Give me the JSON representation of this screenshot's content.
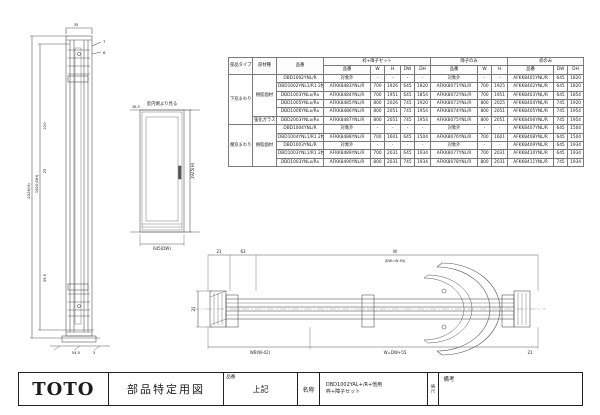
{
  "title_block": {
    "logo": "TOTO",
    "doc_type": "部品特定用図",
    "hinban_label": "品番",
    "hinban_value": "上記",
    "meisho_label": "名称",
    "meisho_line1": "DBD1002YAL+/R+他用",
    "meisho_line2": "枠+障子セット",
    "scale_label": "縮尺",
    "biko_label": "備考"
  },
  "table": {
    "group_headers": [
      "枠+障子セット",
      "障子のみ",
      "枠のみ"
    ],
    "fixed_headers": [
      "部品タイプ",
      "部材種",
      "品番"
    ],
    "sub_headers_set": [
      "品番",
      "W",
      "H",
      "DW",
      "DH"
    ],
    "sub_headers_sash": [
      "品番",
      "W",
      "H"
    ],
    "sub_headers_frame": [
      "品番",
      "DW",
      "DH"
    ],
    "na_text": "対象外",
    "rows": [
      [
        {
          "t": "下窓まわり",
          "rs": 6
        },
        {
          "t": "樹脂面材",
          "rs": 5
        },
        {
          "t": "DBD1002YNL/R"
        },
        {
          "t": "対象外"
        },
        {
          "t": "-"
        },
        {
          "t": "-"
        },
        {
          "t": "-"
        },
        {
          "t": "-"
        },
        {
          "t": "対象外"
        },
        {
          "t": "-"
        },
        {
          "t": "-"
        },
        {
          "t": "AFKK8401YNL/R"
        },
        {
          "t": "645"
        },
        {
          "t": "1820"
        }
      ],
      [
        {
          "t": "DBD1002YNL1/R1 2枚"
        },
        {
          "t": "AFKK8483YNL/R"
        },
        {
          "t": "700"
        },
        {
          "t": "1926"
        },
        {
          "t": "645"
        },
        {
          "t": "1820"
        },
        {
          "t": "AFKK8071YNL/R"
        },
        {
          "t": "700"
        },
        {
          "t": "1925"
        },
        {
          "t": "AFKK8402YNL/R"
        },
        {
          "t": "645"
        },
        {
          "t": "1820"
        }
      ],
      [
        {
          "t": "DBD1003YNLx/Rx"
        },
        {
          "t": "AFKK8484YNL/R"
        },
        {
          "t": "700"
        },
        {
          "t": "1951"
        },
        {
          "t": "645"
        },
        {
          "t": "1854"
        },
        {
          "t": "AFKK8072YNL/R"
        },
        {
          "t": "700"
        },
        {
          "t": "1951"
        },
        {
          "t": "AFKK8403YNL/R"
        },
        {
          "t": "645"
        },
        {
          "t": "1854"
        }
      ],
      [
        {
          "t": "DBD1005YNLx/Rx"
        },
        {
          "t": "AFKK8485YNL/R"
        },
        {
          "t": "800"
        },
        {
          "t": "2026"
        },
        {
          "t": "745"
        },
        {
          "t": "1920"
        },
        {
          "t": "AFKK8073YNL/R"
        },
        {
          "t": "800"
        },
        {
          "t": "2025"
        },
        {
          "t": "AFKK8404YNL/R"
        },
        {
          "t": "745"
        },
        {
          "t": "1920"
        }
      ],
      [
        {
          "t": "DBD1006YNLx/Rx"
        },
        {
          "t": "AFKK8486YNL/R"
        },
        {
          "t": "800"
        },
        {
          "t": "2051"
        },
        {
          "t": "745"
        },
        {
          "t": "1954"
        },
        {
          "t": "AFKK8074YNL/R"
        },
        {
          "t": "800"
        },
        {
          "t": "2051"
        },
        {
          "t": "AFKK8405YNL/R"
        },
        {
          "t": "745"
        },
        {
          "t": "1954"
        }
      ],
      [
        {
          "t": "強化ガラス"
        },
        {
          "t": "DBD2003YNLx/Rx"
        },
        {
          "t": "AFKK8487YNL/R"
        },
        {
          "t": "800"
        },
        {
          "t": "2051"
        },
        {
          "t": "745"
        },
        {
          "t": "1954"
        },
        {
          "t": "AFKK8075YNL/R"
        },
        {
          "t": "800"
        },
        {
          "t": "2051"
        },
        {
          "t": "AFKK8406YNL/R"
        },
        {
          "t": "745"
        },
        {
          "t": "1954"
        }
      ],
      [
        {
          "t": "腰窓まわり",
          "rs": 5
        },
        {
          "t": "樹脂面材",
          "rs": 5
        },
        {
          "t": "DBD1004YNL/R"
        },
        {
          "t": "対象外"
        },
        {
          "t": "-"
        },
        {
          "t": "-"
        },
        {
          "t": "-"
        },
        {
          "t": "-"
        },
        {
          "t": "対象外"
        },
        {
          "t": "-"
        },
        {
          "t": "-"
        },
        {
          "t": "AFKK8407YNL/R"
        },
        {
          "t": "645"
        },
        {
          "t": "1504"
        }
      ],
      [
        {
          "t": "DBD1004YNL1/R1 2枚"
        },
        {
          "t": "AFKK8488YNL/R"
        },
        {
          "t": "700"
        },
        {
          "t": "1601"
        },
        {
          "t": "645"
        },
        {
          "t": "1504"
        },
        {
          "t": "AFKK8076YNL/R"
        },
        {
          "t": "700"
        },
        {
          "t": "1601"
        },
        {
          "t": "AFKK8408YNL/R"
        },
        {
          "t": "645"
        },
        {
          "t": "1504"
        }
      ],
      [
        {
          "t": "DBD1003YNL/R"
        },
        {
          "t": "対象外"
        },
        {
          "t": "-"
        },
        {
          "t": "-"
        },
        {
          "t": "-"
        },
        {
          "t": "-"
        },
        {
          "t": "対象外"
        },
        {
          "t": "-"
        },
        {
          "t": "-"
        },
        {
          "t": "AFKK8409YNL/R"
        },
        {
          "t": "645"
        },
        {
          "t": "1934"
        }
      ],
      [
        {
          "t": "DBD1003YNL1/R1 2枚"
        },
        {
          "t": "AFKK8489YNL/R"
        },
        {
          "t": "700"
        },
        {
          "t": "2031"
        },
        {
          "t": "645"
        },
        {
          "t": "1934"
        },
        {
          "t": "AFKK8077YNL/R"
        },
        {
          "t": "700"
        },
        {
          "t": "2031"
        },
        {
          "t": "AFKK8410YNL/R"
        },
        {
          "t": "645"
        },
        {
          "t": "1934"
        }
      ],
      [
        {
          "t": "DBD1003YNLx/Rx"
        },
        {
          "t": "AFKK8490YNL/R"
        },
        {
          "t": "800"
        },
        {
          "t": "2031"
        },
        {
          "t": "745"
        },
        {
          "t": "1934"
        },
        {
          "t": "AFKK8078YNL/R"
        },
        {
          "t": "800"
        },
        {
          "t": "2031"
        },
        {
          "t": "AFKK8411YNL/R"
        },
        {
          "t": "745"
        },
        {
          "t": "1934"
        }
      ]
    ]
  },
  "left_drawing": {
    "dims": [
      "35",
      "7",
      "8",
      "220",
      "25",
      "39.5",
      "54.5",
      "3",
      "2026(H)",
      "1820(DH)"
    ]
  },
  "elevation": {
    "caption": "室内側より見る",
    "dims": [
      "38.5",
      "1925(H)",
      "645(DW)"
    ]
  },
  "section": {
    "dims": [
      "21",
      "63",
      "W",
      "(DW=W-55)",
      "WB(W-42)",
      "W=DW+55",
      "21",
      "21"
    ]
  }
}
